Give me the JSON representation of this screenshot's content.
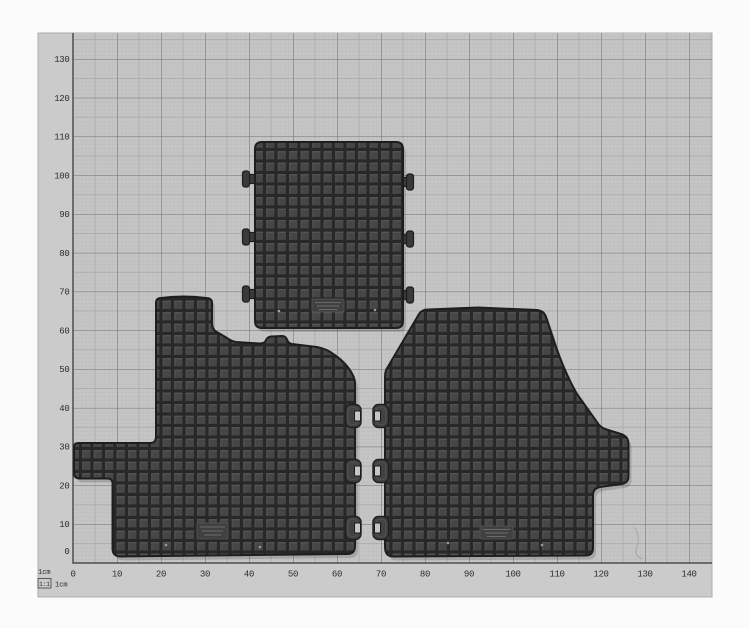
{
  "axes": {
    "x_tick_labels": [
      "0",
      "10",
      "20",
      "30",
      "40",
      "50",
      "60",
      "70",
      "80",
      "90",
      "100",
      "110",
      "120",
      "130",
      "140"
    ],
    "y_tick_labels": [
      "0",
      "10",
      "20",
      "30",
      "40",
      "50",
      "60",
      "70",
      "80",
      "90",
      "100",
      "110",
      "120",
      "130"
    ]
  },
  "scale_legend": {
    "line1": "1cm",
    "ratio_badge": "1:1",
    "line2_unit": "1cm"
  },
  "colors": {
    "page_bg": "#fbfbfb",
    "board_bg": "#cbcbcb",
    "grid_bg": "#c4c5c4",
    "grid_minor": "#b2b3b2",
    "grid_mid": "#a6a7a6",
    "grid_major": "#6f706f",
    "axis_line": "#4e4e4e",
    "tick_text": "#2d2d2d",
    "mat_base": "#3d3d3d",
    "mat_groove": "#282828",
    "mat_cell": "#464646",
    "mat_cell_hi": "#575757",
    "mat_outline": "#1e1e1e",
    "diamond_bg": "#353535",
    "diamond_bar": "#4b4b4b",
    "notch": "#c6c7c6",
    "plate_line": "#6b6b6b"
  }
}
